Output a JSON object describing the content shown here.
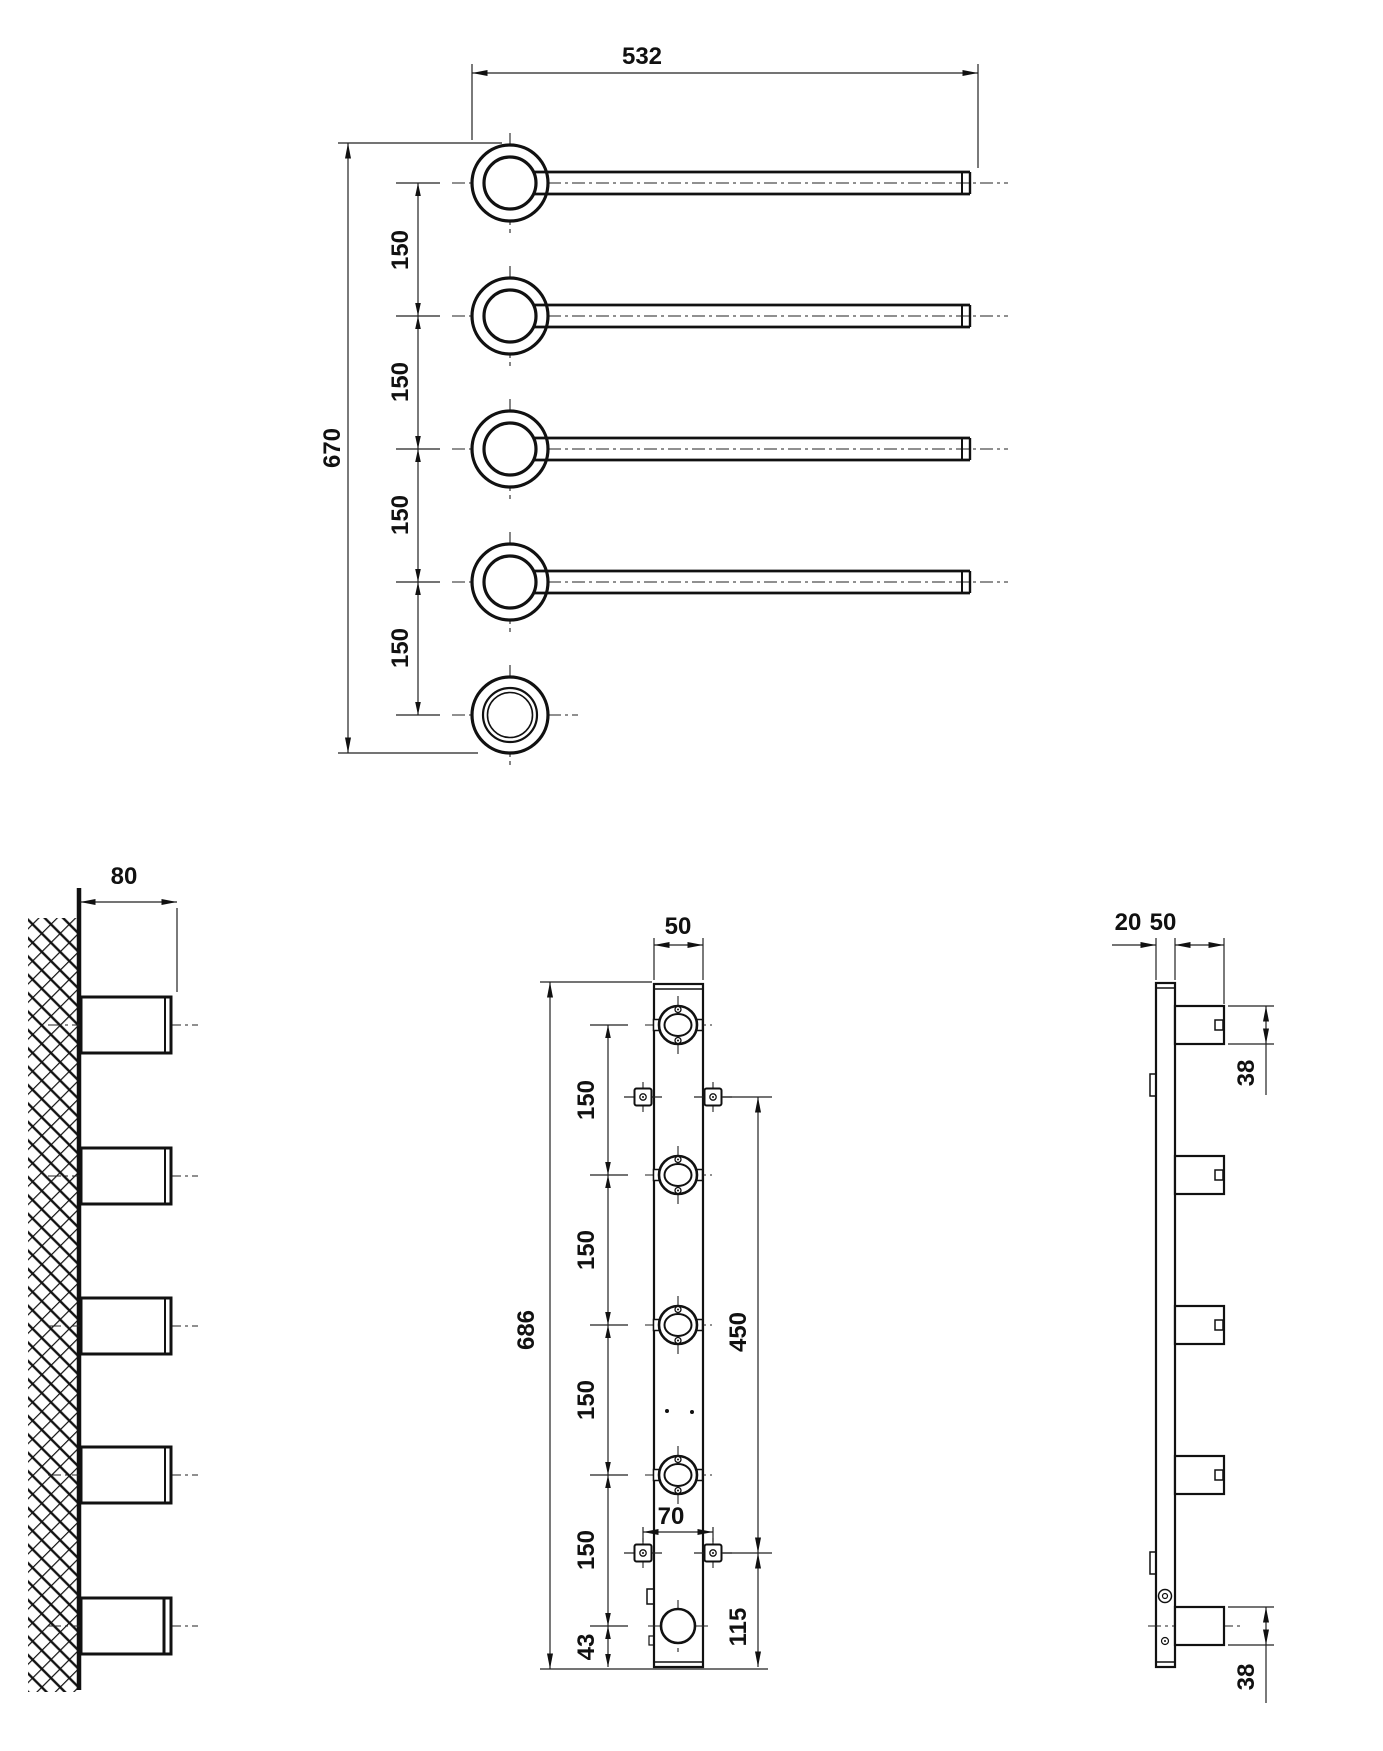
{
  "plan": {
    "length": "532",
    "height": "670",
    "pitch": [
      "150",
      "150",
      "150",
      "150"
    ]
  },
  "wall": {
    "protrusion": "80"
  },
  "front": {
    "width": "50",
    "height": "686",
    "pitch": [
      "150",
      "150",
      "150",
      "150"
    ],
    "bottom_offset": "43",
    "mount_span": "450",
    "mount_width": "70",
    "mount_bottom": "115"
  },
  "profile": {
    "depth": "20",
    "arm_length": "50",
    "arm_top": "38",
    "arm_bottom": "38"
  }
}
